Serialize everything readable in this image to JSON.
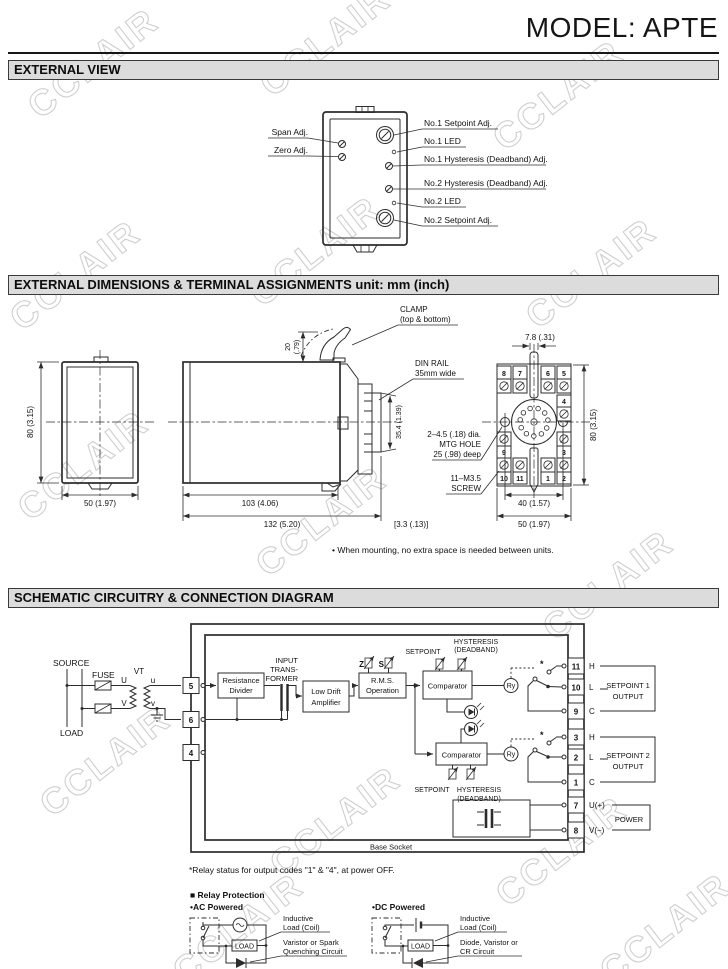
{
  "page": {
    "model_title": "MODEL: APTE"
  },
  "watermark": {
    "text": "CCLAIR"
  },
  "external_view": {
    "title": "EXTERNAL VIEW",
    "left_labels": [
      "Span Adj.",
      "Zero Adj."
    ],
    "right_labels": [
      "No.1 Setpoint Adj.",
      "No.1 LED",
      "No.1 Hysteresis (Deadband) Adj.",
      "No.2 Hysteresis (Deadband) Adj.",
      "No.2 LED",
      "No.2 Setpoint Adj."
    ]
  },
  "dimensions": {
    "title": "EXTERNAL DIMENSIONS & TERMINAL ASSIGNMENTS unit: mm (inch)",
    "front": {
      "height": "80 (3.15)",
      "width": "50 (1.97)"
    },
    "side": {
      "clamp1": "CLAMP",
      "clamp2": "(top & bottom)",
      "clamp_h1": "20",
      "clamp_h2": "(.79)",
      "din1": "DIN RAIL",
      "din2": "35mm wide",
      "rail_height": "35.4 (1.39)",
      "body_depth": "103 (4.06)",
      "total_depth": "132 (5.20)",
      "offset": "[3.3 (.13)]"
    },
    "rear": {
      "pitch": "7.8 (.31)",
      "height": "80 (3.15)",
      "hole_span": "40 (1.57)",
      "width": "50 (1.97)",
      "mtg1": "2–4.5 (.18) dia.",
      "mtg2": "MTG HOLE",
      "mtg3": "25 (.98) deep",
      "screw1": "11–M3.5",
      "screw2": "SCREW",
      "terminals": [
        "8",
        "7",
        "6",
        "5",
        "4",
        "9",
        "3",
        "10",
        "11",
        "1",
        "2"
      ]
    },
    "note": "• When mounting, no extra space is needed between units."
  },
  "schematic": {
    "title": "SCHEMATIC CIRCUITRY & CONNECTION DIAGRAM",
    "source": "SOURCE",
    "load": "LOAD",
    "fuse": "FUSE",
    "vt": "VT",
    "u_upper": "U",
    "u_lower": "u",
    "v_upper": "V",
    "v_lower": "v",
    "left_terminals": [
      "5",
      "6",
      "4"
    ],
    "blocks": {
      "resistance1": "Resistance",
      "resistance2": "Divider",
      "xfmr1": "INPUT",
      "xfmr2": "TRANS-",
      "xfmr3": "FORMER",
      "amp1": "Low Drift",
      "amp2": "Amplifier",
      "rms1": "R.M.S.",
      "rms2": "Operation",
      "comparator": "Comparator",
      "ry": "Ry",
      "z": "Z",
      "s": "S"
    },
    "setpoint": "SETPOINT",
    "hyst1": "HYSTERESIS",
    "hyst2": "(DEADBAND)",
    "asterisk": "*",
    "right_terminals": [
      {
        "num": "11",
        "pin": "H"
      },
      {
        "num": "10",
        "pin": "L"
      },
      {
        "num": "9",
        "pin": "C"
      },
      {
        "num": "3",
        "pin": "H"
      },
      {
        "num": "2",
        "pin": "L"
      },
      {
        "num": "1",
        "pin": "C"
      },
      {
        "num": "7",
        "pin": "U(+)"
      },
      {
        "num": "8",
        "pin": "V(−)"
      }
    ],
    "out1a": "SETPOINT 1",
    "out1b": "OUTPUT",
    "out2a": "SETPOINT 2",
    "out2b": "OUTPUT",
    "power": "POWER",
    "base_socket": "Base Socket",
    "footnote": "*Relay status for output codes \"1\" & \"4\", at power OFF."
  },
  "relay_protection": {
    "heading": "■ Relay Protection",
    "ac": "•AC Powered",
    "dc": "•DC Powered",
    "load": "LOAD",
    "ac_l1a": "Inductive",
    "ac_l1b": "Load (Coil)",
    "ac_l2a": "Varistor or Spark",
    "ac_l2b": "Quenching Circuit",
    "dc_l1a": "Inductive",
    "dc_l1b": "Load (Coil)",
    "dc_l2a": "Diode, Varistor or",
    "dc_l2b": "CR Circuit"
  }
}
